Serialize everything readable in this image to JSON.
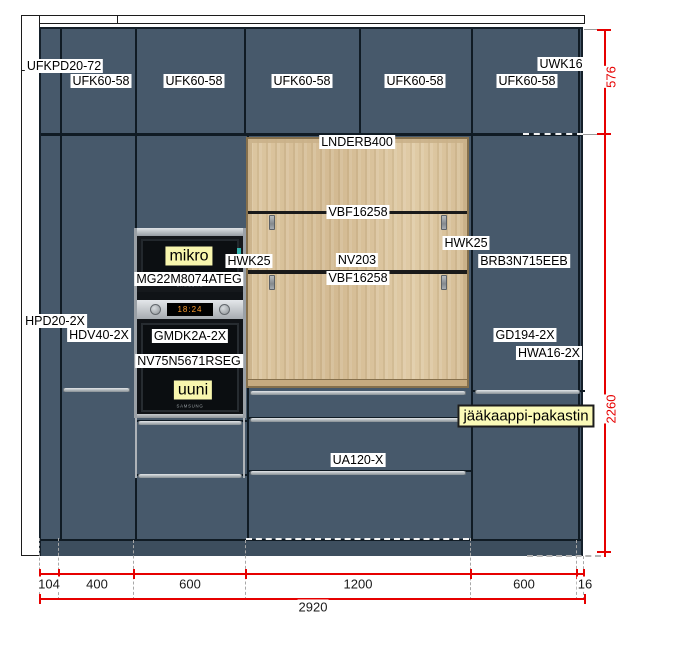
{
  "labels": {
    "product": [
      {
        "text": "UFKPD20-72",
        "x": 64,
        "y": 66
      },
      {
        "text": "UFK60-58",
        "x": 101,
        "y": 81
      },
      {
        "text": "UFK60-58",
        "x": 194,
        "y": 81
      },
      {
        "text": "UFK60-58",
        "x": 302,
        "y": 81
      },
      {
        "text": "UFK60-58",
        "x": 415,
        "y": 81
      },
      {
        "text": "UFK60-58",
        "x": 527,
        "y": 81
      },
      {
        "text": "UWK16",
        "x": 561,
        "y": 64
      },
      {
        "text": "LNDERB400",
        "x": 357,
        "y": 142
      },
      {
        "text": "VBF16258",
        "x": 358,
        "y": 212
      },
      {
        "text": "HWK25",
        "x": 249,
        "y": 261
      },
      {
        "text": "NV203",
        "x": 357,
        "y": 260
      },
      {
        "text": "VBF16258",
        "x": 358,
        "y": 278
      },
      {
        "text": "HWK25",
        "x": 466,
        "y": 243
      },
      {
        "text": "BRB3N715EEB",
        "x": 524,
        "y": 261
      },
      {
        "text": "MG22M8074ATEG",
        "x": 189,
        "y": 279
      },
      {
        "text": "HPD20-2X",
        "x": 55,
        "y": 321
      },
      {
        "text": "HDV40-2X",
        "x": 99,
        "y": 335
      },
      {
        "text": "GMDK2A-2X",
        "x": 190,
        "y": 336
      },
      {
        "text": "NV75N5671RSEG",
        "x": 189,
        "y": 361
      },
      {
        "text": "GD194-2X",
        "x": 525,
        "y": 335
      },
      {
        "text": "HWA16-2X",
        "x": 549,
        "y": 353
      },
      {
        "text": "UA120-X",
        "x": 358,
        "y": 460
      }
    ],
    "highlight": [
      {
        "text": "mikro",
        "x": 189,
        "y": 256,
        "bordered": false
      },
      {
        "text": "uuni",
        "x": 193,
        "y": 390,
        "bordered": false
      },
      {
        "text": "jääkaappi-pakastin",
        "x": 526,
        "y": 416,
        "bordered": true
      }
    ]
  },
  "dimensions": {
    "vertical": [
      {
        "value": "576",
        "x": 611,
        "y": 77
      },
      {
        "value": "2260",
        "x": 611,
        "y": 409
      }
    ],
    "bottom_segments": [
      {
        "value": "104",
        "x": 49
      },
      {
        "value": "400",
        "x": 97
      },
      {
        "value": "600",
        "x": 190
      },
      {
        "value": "1200",
        "x": 358
      },
      {
        "value": "600",
        "x": 524
      },
      {
        "value": "16",
        "x": 585
      }
    ],
    "total": {
      "value": "2920",
      "x": 313,
      "y": 607
    }
  },
  "appliances": {
    "microwave": {
      "brand": "SAMSUNG"
    },
    "oven": {
      "brand": "SAMSUNG",
      "display": "18:24"
    }
  },
  "colors": {
    "cabinet_front": "#47596b",
    "plinth": "#3d4e5e",
    "wood": "#d9c29c",
    "dimension_red": "#e60000",
    "highlight_yellow": "#f8f6ae",
    "label_bg": "#ffffff"
  }
}
